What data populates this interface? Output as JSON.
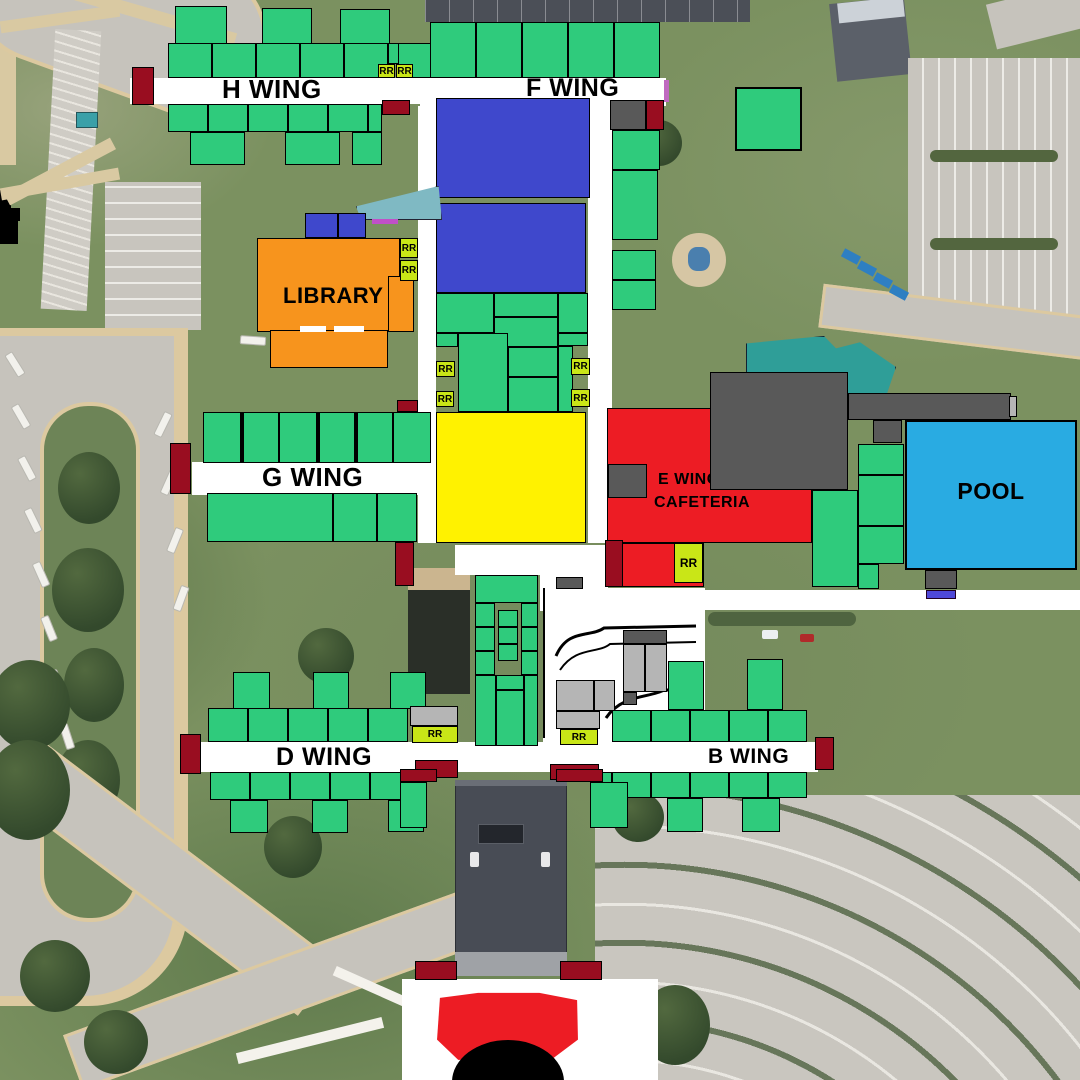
{
  "labels": {
    "h_wing": "H WING",
    "f_wing": "F WING",
    "g_wing": "G WING",
    "d_wing": "D WING",
    "b_wing": "B WING",
    "e_wing_line1": "E WING",
    "e_wing_line2": "CAFETERIA",
    "library": "LIBRARY",
    "pool": "POOL",
    "restroom": "RR"
  },
  "colors": {
    "block_green": "#2fcb7c",
    "block_blue": "#3f48cc",
    "block_orange": "#f7941d",
    "block_yellow": "#fff200",
    "block_red": "#ed1c24",
    "block_dark_red": "#990d20",
    "block_pool_blue": "#29abe2",
    "rr_green": "#c9e617",
    "gray_dark": "#595959",
    "gray_light": "#b5b5b5",
    "black": "#000000",
    "white": "#ffffff"
  }
}
